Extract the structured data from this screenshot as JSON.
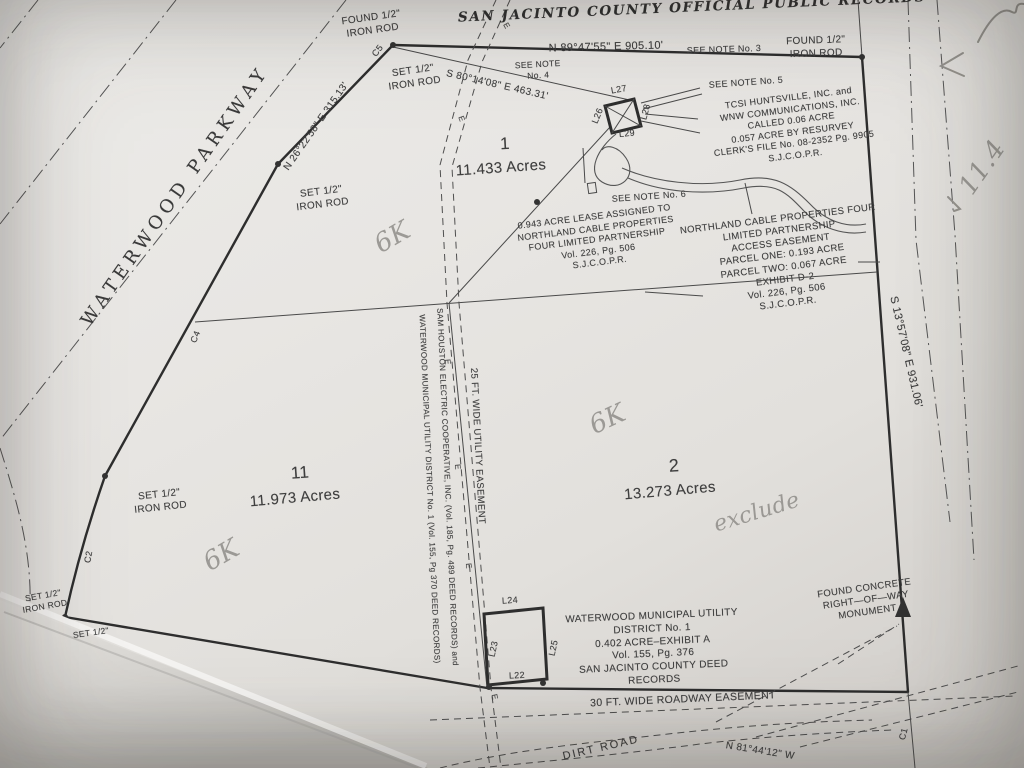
{
  "header": {
    "title": "SAN JACINTO COUNTY OFFICIAL PUBLIC RECORDS"
  },
  "parcels": {
    "p1": {
      "num": "1",
      "area": "11.433 Acres"
    },
    "p2": {
      "num": "2",
      "area": "13.273 Acres"
    },
    "p11": {
      "num": "11",
      "area": "11.973 Acres"
    }
  },
  "bearings": {
    "north": "N 89°47'55\" E   905.10'",
    "northwest": "S 80°14'08\" E   463.31'",
    "parkway": "N 26°22'58\" E  315.13'",
    "east": "S 13°57'08\" E   931.06'",
    "south": "N 81°44'12\" W"
  },
  "roads": {
    "parkway": "WATERWOOD PARKWAY",
    "dirt": "DIRT ROAD"
  },
  "notes": {
    "n3": "SEE NOTE No. 3",
    "n4a": "SEE NOTE",
    "n4b": "No. 4",
    "n5": "SEE NOTE No. 5",
    "n6": "SEE NOTE No. 6"
  },
  "monuments": {
    "found_a": "FOUND 1/2\"",
    "found_b": "IRON ROD",
    "set_a": "SET 1/2\"",
    "set_b": "IRON ROD",
    "conc1": "FOUND CONCRETE",
    "conc2": "RIGHT—OF—WAY",
    "conc3": "MONUMENT"
  },
  "blocks": {
    "tcsi": [
      "TCSI HUNTSVILLE, INC. and",
      "WNW COMMUNICATIONS, INC.",
      "CALLED 0.06 ACRE",
      "0.057 ACRE BY RESURVEY",
      "CLERK'S FILE No. 08-2352 Pg. 9905",
      "S.J.C.O.P.R."
    ],
    "lease": [
      "0.943 ACRE LEASE ASSIGNED TO",
      "NORTHLAND CABLE PROPERTIES",
      "FOUR LIMITED PARTNERSHIP",
      "Vol. 226, Pg. 506",
      "S.J.C.O.P.R."
    ],
    "access": [
      "NORTHLAND CABLE PROPERTIES FOUR",
      "LIMITED PARTNERSHIP",
      "ACCESS EASEMENT",
      "PARCEL ONE: 0.193 ACRE",
      "PARCEL TWO: 0.067 ACRE",
      "EXHIBIT D-2",
      "Vol. 226, Pg. 506",
      "S.J.C.O.P.R."
    ],
    "wmud": [
      "WATERWOOD MUNICIPAL UTILITY",
      "DISTRICT No. 1",
      "0.402 ACRE–EXHIBIT A",
      "Vol. 155, Pg. 376",
      "SAN JACINTO COUNTY DEED",
      "RECORDS"
    ]
  },
  "easements": {
    "utility": "25 FT. WIDE UTILITY EASEMENT",
    "owner1": "SAM HOUSTON ELECTRIC COOPERATIVE, INC. (Vol. 185, Pg. 489 DEED RECORDS) and",
    "owner2": "WATERWOOD MUNICIPAL UTILITY DISTRICT No. 1 (Vol. 155, Pg 370 DEED RECORDS)",
    "roadway": "30 FT. WIDE ROADWAY EASEMENT",
    "marker": "E"
  },
  "line_labels": {
    "l22": "L22",
    "l23": "L23",
    "l24": "L24",
    "l25": "L25",
    "l26": "L26",
    "l27": "L27",
    "l28": "L28",
    "l29": "L29"
  },
  "curve_labels": {
    "c1": "C1",
    "c2": "C2",
    "c4": "C4",
    "c5": "C5"
  },
  "handwriting": {
    "hk": "6K",
    "exclude": "exclude",
    "num": "11.4"
  }
}
